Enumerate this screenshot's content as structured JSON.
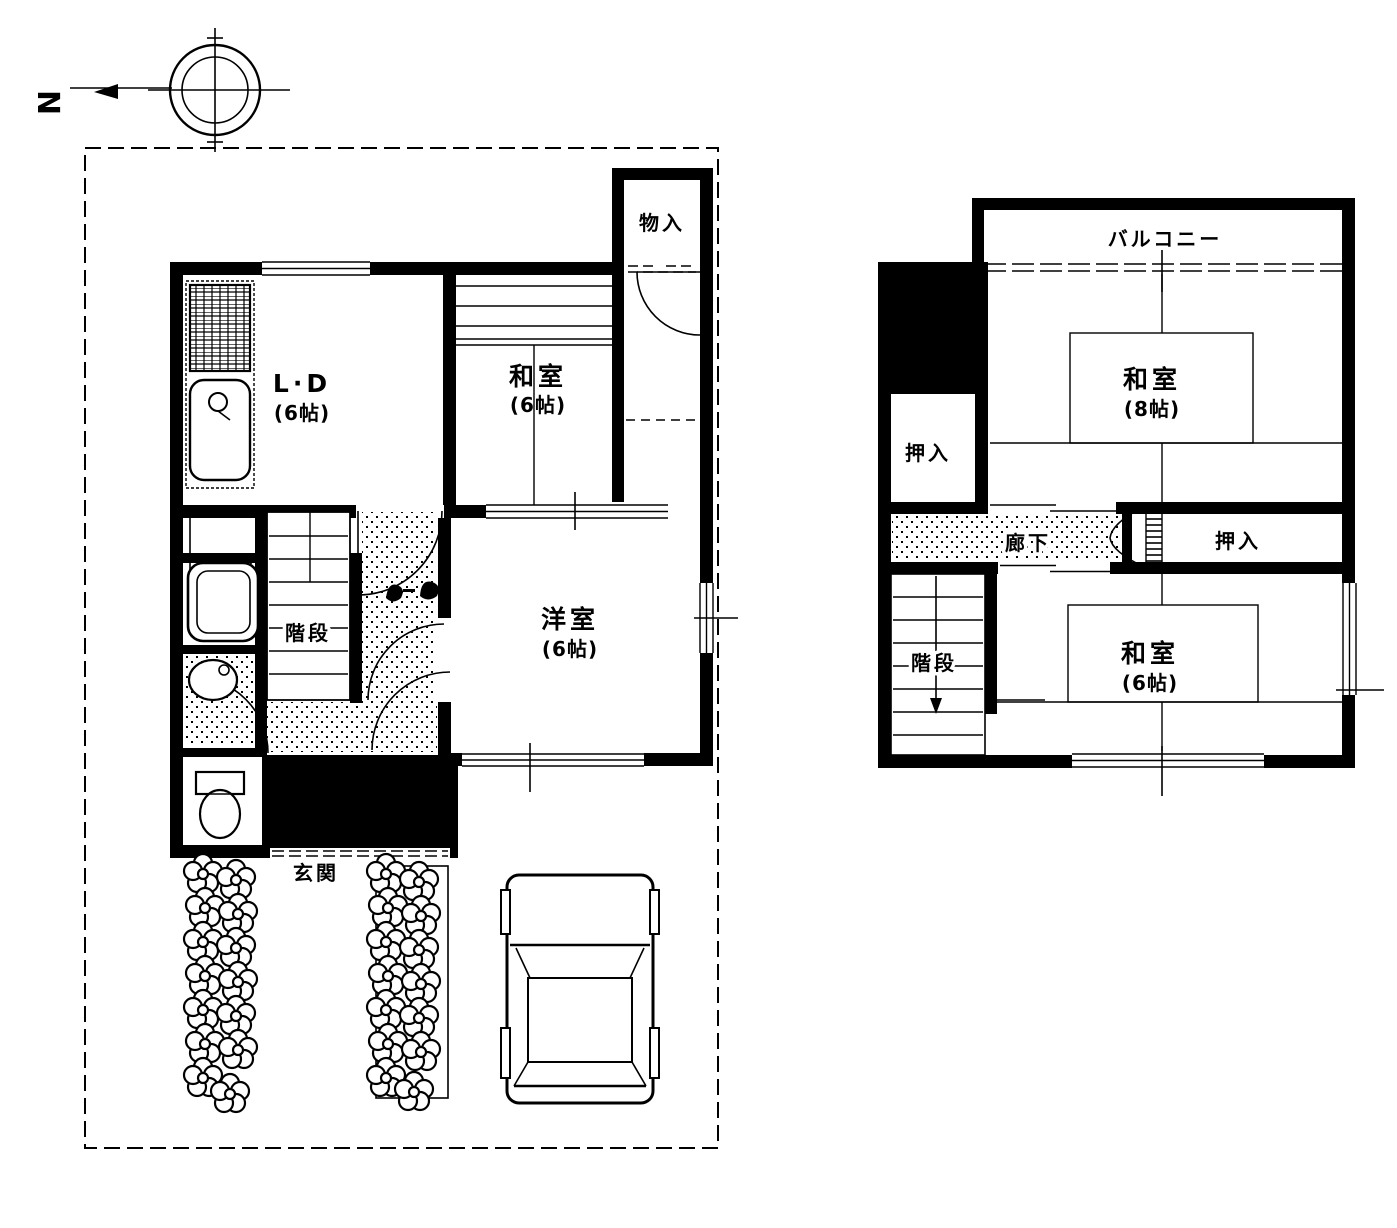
{
  "compass": {
    "north_label": "N"
  },
  "floor1": {
    "living_dining": {
      "label": "L·D",
      "size": "(6帖)"
    },
    "japanese_room": {
      "label": "和室",
      "size": "(6帖)"
    },
    "storage": {
      "label": "物入"
    },
    "western_room": {
      "label": "洋室",
      "size": "(6帖)"
    },
    "stairs": {
      "label": "階段"
    },
    "entrance": {
      "label": "玄関"
    }
  },
  "floor2": {
    "balcony": {
      "label": "バルコニー"
    },
    "closet_left": {
      "label": "押入"
    },
    "japanese_room_8": {
      "label": "和室",
      "size": "(8帖)"
    },
    "hallway": {
      "label": "廊下"
    },
    "closet_right": {
      "label": "押入"
    },
    "stairs": {
      "label": "階段"
    },
    "japanese_room_6": {
      "label": "和室",
      "size": "(6帖)"
    }
  },
  "colors": {
    "ink": "#000000",
    "paper": "#ffffff"
  }
}
